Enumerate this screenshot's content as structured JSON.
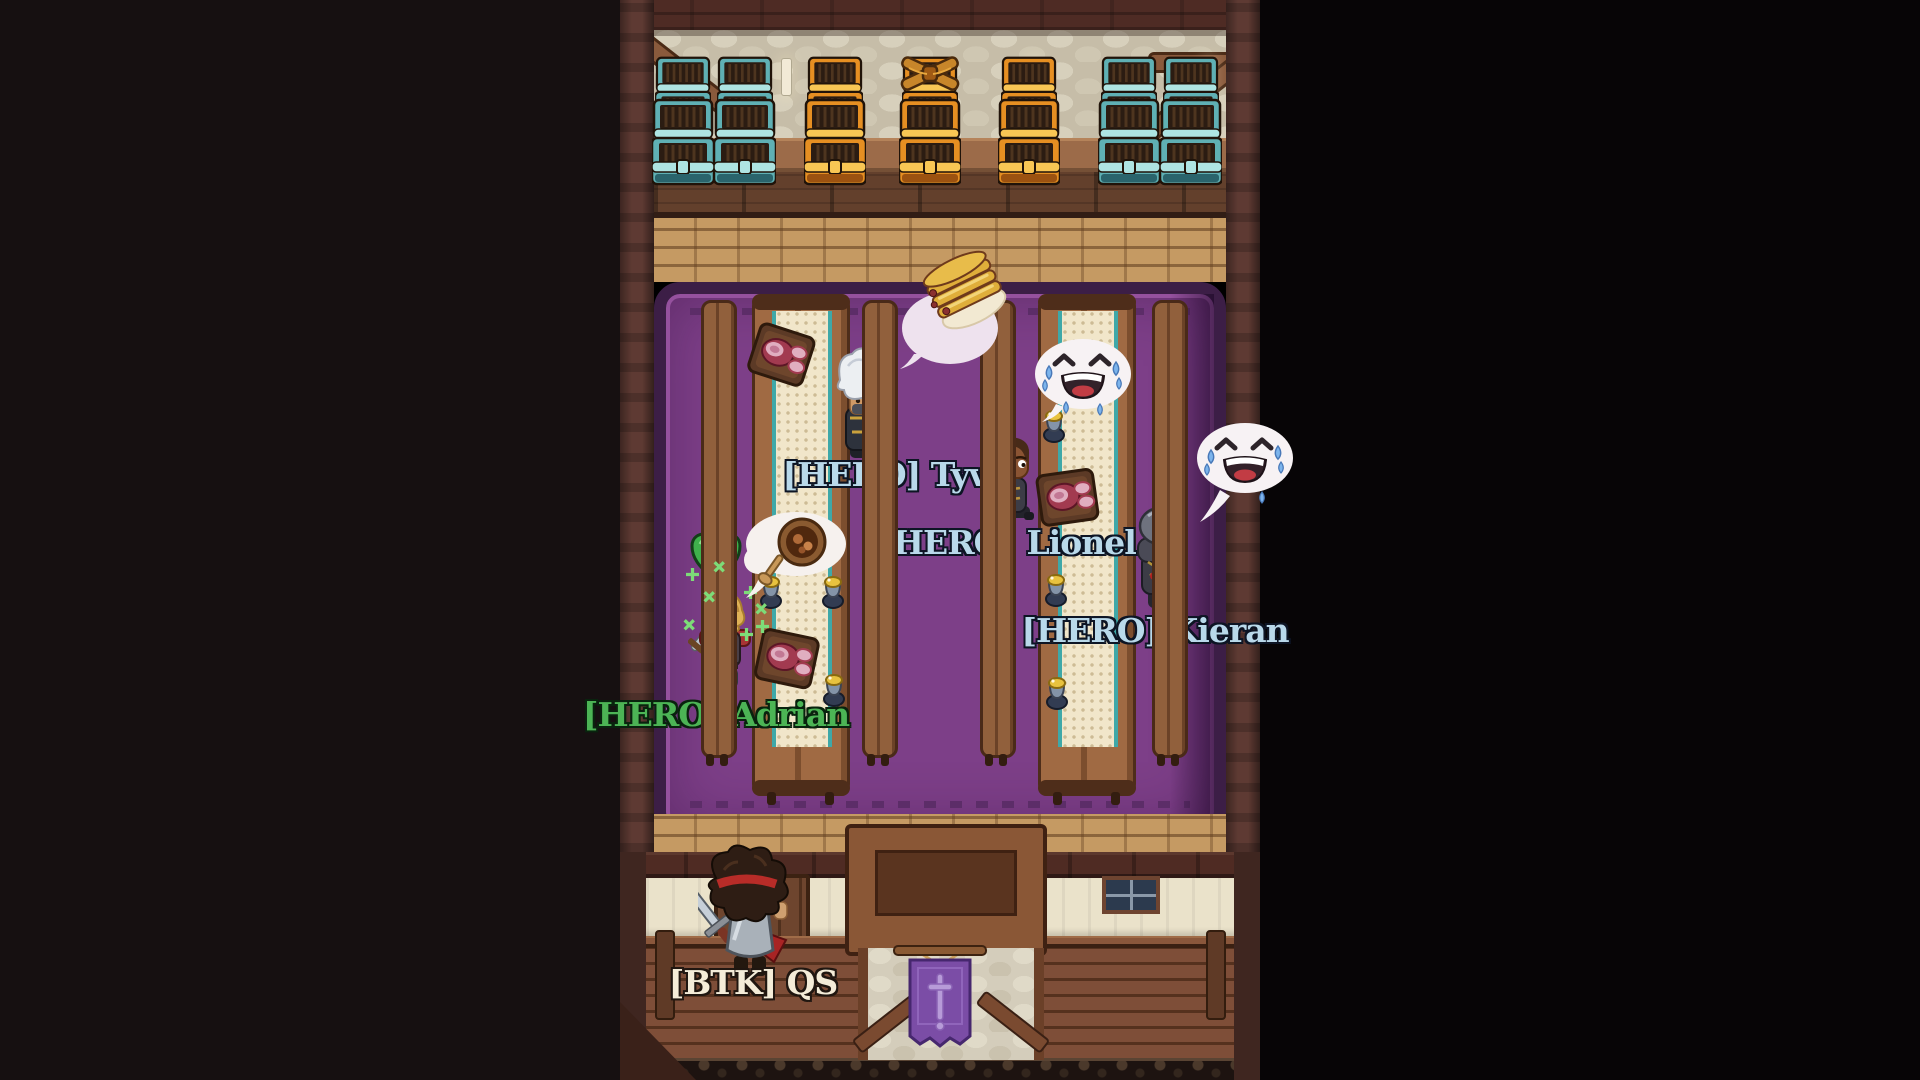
{
  "players": [
    {
      "id": "tyva",
      "name": "[HERO] Tyva",
      "name_color": "#b9d9ea"
    },
    {
      "id": "lionel",
      "name": "[HERO] Lionel",
      "name_color": "#b9d9ea"
    },
    {
      "id": "kieran",
      "name": "[HERO] Kieran",
      "name_color": "#b9d9ea"
    },
    {
      "id": "adrian",
      "name": "[HERO] Adrian",
      "name_color": "#4cb455"
    },
    {
      "id": "qs",
      "name": "[BTK] QS",
      "name_color": "#f4ecd8"
    }
  ],
  "effects": {
    "heal_value": "4",
    "heal_heart_color": "#3fb04c",
    "sparkle_color": "#7ddc78"
  },
  "bubbles": [
    {
      "owner": "tyva",
      "icon": "pancake-stack-icon"
    },
    {
      "owner": "lionel",
      "icon": "joy-tears-emoji-icon"
    },
    {
      "owner": "kieran",
      "icon": "joy-tears-emoji-icon"
    },
    {
      "owner": "adrian",
      "icon": "stew-bowl-icon"
    }
  ],
  "scene": {
    "chests": [
      "teal",
      "teal",
      "orange",
      "orange",
      "orange",
      "teal",
      "teal"
    ],
    "chest_decoration": "bow-on-middle-orange-chest",
    "banner_emblem": "sword",
    "palette": {
      "carpet": "#7d3f88",
      "carpet_border": "#3c1e46",
      "wood_floor": "#c59a63",
      "wall_wood": "#5e3a33",
      "stone_wall": "#c6bda8",
      "chest_teal": "#5fb0b4",
      "chest_orange": "#e68f22",
      "tag_blue": "#b9d9ea",
      "tag_green": "#4cb455",
      "tag_cream": "#f4ecd8"
    }
  }
}
